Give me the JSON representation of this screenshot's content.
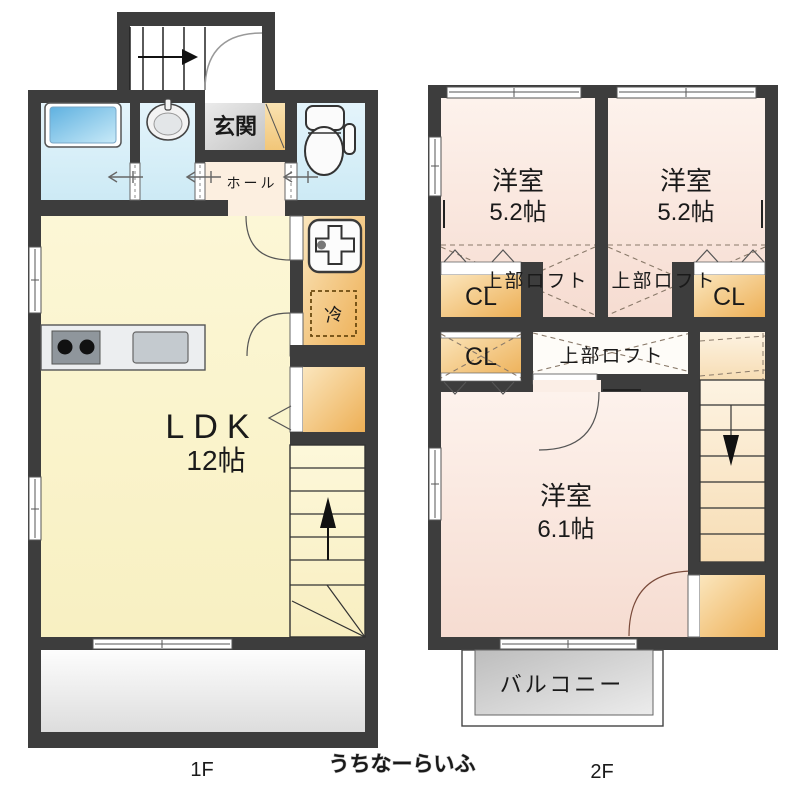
{
  "f1": {
    "label": "1F",
    "ldk_name": "LDK",
    "ldk_size": "12帖",
    "genkan": "玄関",
    "hall": "ホール",
    "refrigerator": "冷"
  },
  "f2": {
    "label": "2F",
    "bedroom1_name": "洋室",
    "bedroom1_size": "5.2帖",
    "bedroom2_name": "洋室",
    "bedroom2_size": "5.2帖",
    "bedroom3_name": "洋室",
    "bedroom3_size": "6.1帖",
    "loft_label": "上部ロフト",
    "closet_label": "CL",
    "balcony": "バルコニー"
  },
  "watermark": "うちなーらいふ",
  "colors": {
    "wall": "#3d3d3d",
    "ldk_yellow": "#faf4cc",
    "bedroom_pink": "#f8e3d9",
    "wet_blue": "#d9eff8",
    "closet_orange": "#f2bf74",
    "tile_gray": "#d7d7d7",
    "balcony_gray": "#cfcfcf",
    "stair_cream": "#fbf0d8",
    "line_dark": "#333333"
  }
}
